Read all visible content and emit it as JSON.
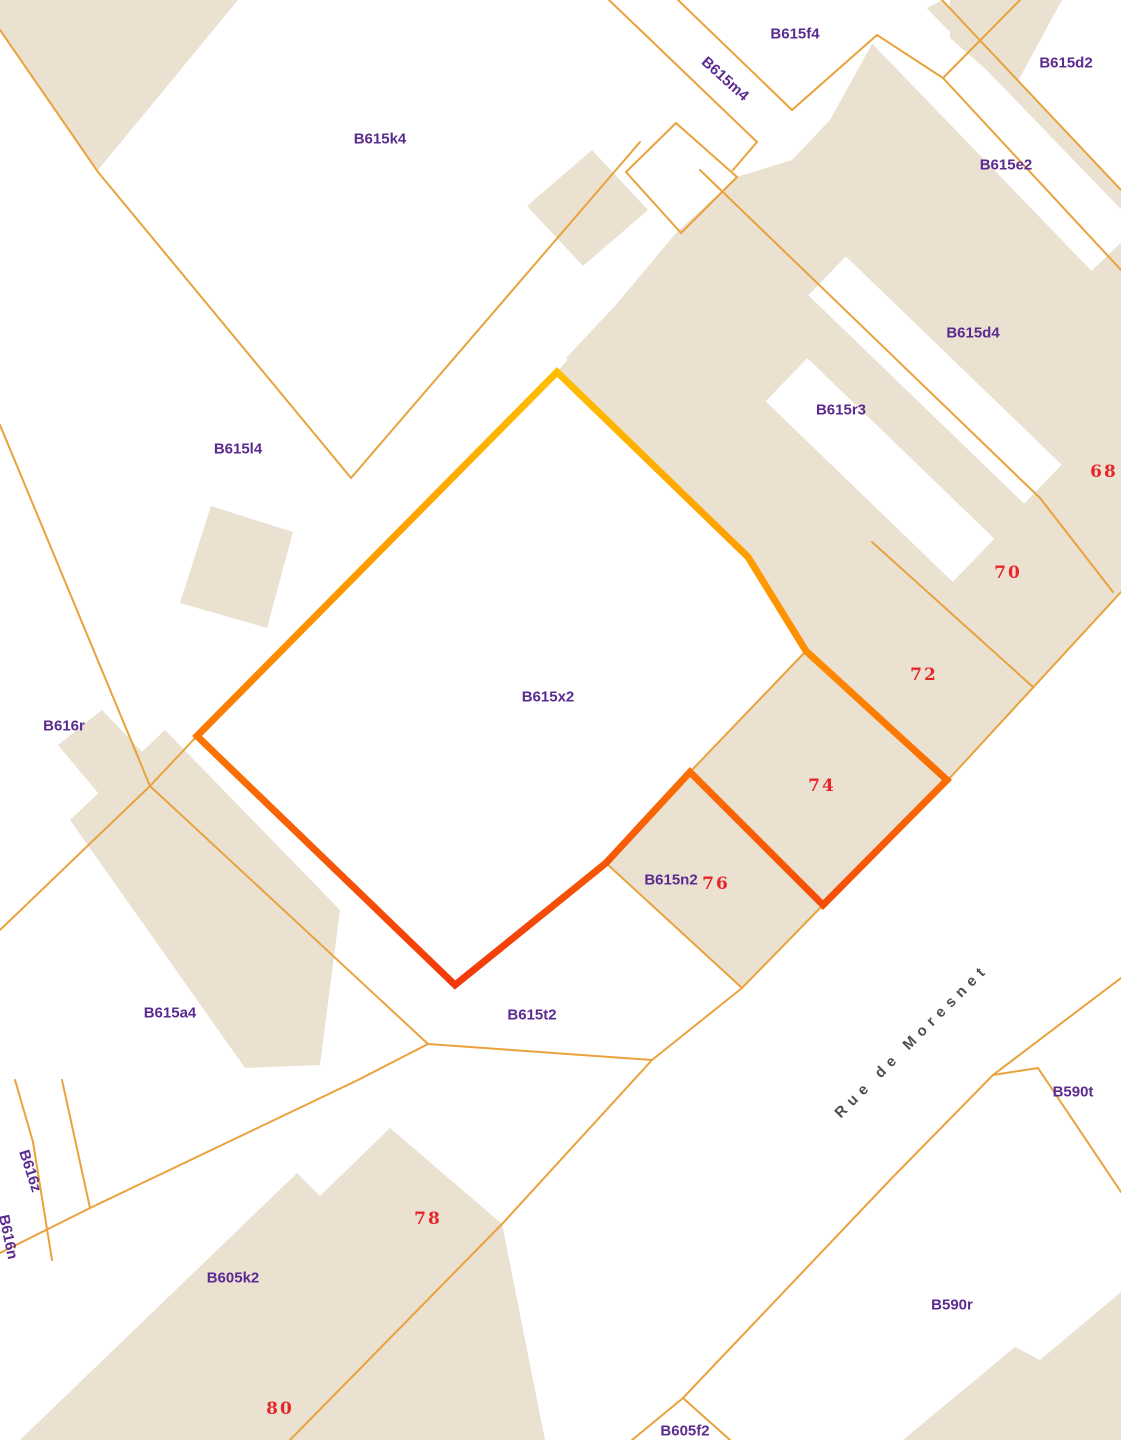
{
  "map": {
    "type": "cadastral-parcel-map",
    "street": {
      "name": "Rue de Moresnet"
    },
    "highlight": {
      "parcel": "B615x2",
      "gradient_top": "#FFBE00",
      "gradient_mid": "#FF8E00",
      "gradient_bottom": "#F2380A"
    },
    "colors": {
      "background": "#FFFFFF",
      "building_fill": "#EAE1D1",
      "parcel_line": "#E9A23C",
      "parcel_label": "#5B2B8F",
      "house_number": "#E6262B",
      "street_label": "#4E4E4E"
    },
    "parcel_labels": [
      {
        "id": "B615k4",
        "text": "B615k4"
      },
      {
        "id": "B615f4",
        "text": "B615f4"
      },
      {
        "id": "B615m4",
        "text": "B615m4"
      },
      {
        "id": "B615d2",
        "text": "B615d2"
      },
      {
        "id": "B615e2",
        "text": "B615e2"
      },
      {
        "id": "B615d4",
        "text": "B615d4"
      },
      {
        "id": "B615r3",
        "text": "B615r3"
      },
      {
        "id": "B615l4",
        "text": "B615l4"
      },
      {
        "id": "B615x2",
        "text": "B615x2"
      },
      {
        "id": "B616r",
        "text": "B616r"
      },
      {
        "id": "B615n2",
        "text": "B615n2"
      },
      {
        "id": "B615a4",
        "text": "B615a4"
      },
      {
        "id": "B615t2",
        "text": "B615t2"
      },
      {
        "id": "B590t",
        "text": "B590t"
      },
      {
        "id": "B616z",
        "text": "B616z"
      },
      {
        "id": "B616n",
        "text": "B616n"
      },
      {
        "id": "B605k2",
        "text": "B605k2"
      },
      {
        "id": "B590r",
        "text": "B590r"
      },
      {
        "id": "B605f2",
        "text": "B605f2"
      }
    ],
    "house_numbers": [
      {
        "text": "68"
      },
      {
        "text": "70"
      },
      {
        "text": "72"
      },
      {
        "text": "74"
      },
      {
        "text": "76"
      },
      {
        "text": "78"
      },
      {
        "text": "80"
      }
    ]
  }
}
